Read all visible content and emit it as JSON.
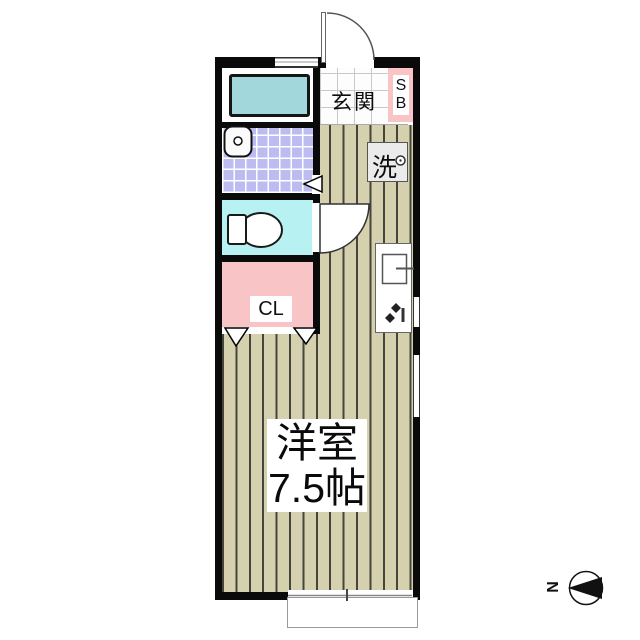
{
  "rooms": {
    "entrance": {
      "label": "玄関"
    },
    "shoe_box": {
      "letter_top": "S",
      "letter_bottom": "B"
    },
    "washing_machine": {
      "label": "洗"
    },
    "closet": {
      "label": "CL"
    },
    "western_room": {
      "name": "洋室",
      "area": "7.5帖"
    }
  },
  "compass": {
    "north_label": "N"
  },
  "colors": {
    "wall": "#0a0a0a",
    "flooring": "#d5d1af",
    "flooring_line": "#45453b",
    "closet_pink": "#f9c4c6",
    "washroom_tile": "#bcbcf0",
    "toilet_aqua": "#b8f1f1",
    "bathtub_blue": "#a2d8db",
    "washer_gray": "#ebebeb"
  }
}
